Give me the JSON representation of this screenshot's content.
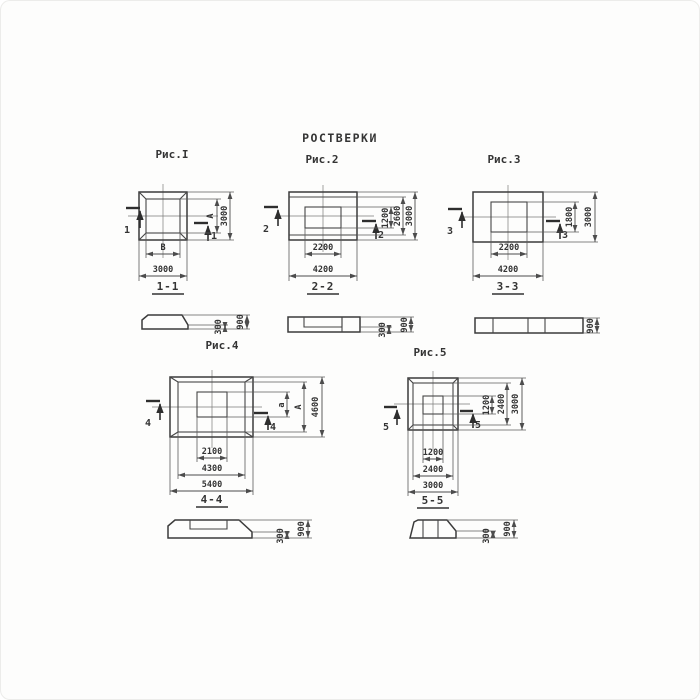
{
  "title": "РОСТВЕРКИ",
  "figures": {
    "fig1": {
      "caption": "Рис.I",
      "cut_number": "1",
      "section_title": "1-1",
      "inner_width": "В",
      "outer_width": "3000",
      "inner_height": "А",
      "outer_height": "3000",
      "section_bottom": "300",
      "section_total": "900"
    },
    "fig2": {
      "caption": "Рис.2",
      "cut_number": "2",
      "section_title": "2-2",
      "inner_width": "2200",
      "outer_width": "4200",
      "inner_height": "1200",
      "mid_height": "2600",
      "outer_height": "3000",
      "section_bottom": "300",
      "section_total": "900"
    },
    "fig3": {
      "caption": "Рис.3",
      "cut_number": "3",
      "section_title": "3-3",
      "inner_width": "2200",
      "outer_width": "4200",
      "inner_height": "1800",
      "outer_height": "3000",
      "section_total": "900"
    },
    "fig4": {
      "caption": "Рис.4",
      "cut_number": "4",
      "section_title": "4-4",
      "inner_width": "2100",
      "mid_width": "4300",
      "outer_width": "5400",
      "inner_height": "а",
      "mid_height": "А",
      "outer_height": "4600",
      "section_bottom": "300",
      "section_total": "900"
    },
    "fig5": {
      "caption": "Рис.5",
      "cut_number": "5",
      "section_title": "5-5",
      "inner_width": "1200",
      "mid_width": "2400",
      "outer_width": "3000",
      "inner_height": "1200",
      "mid_height": "2400",
      "outer_height": "3000",
      "section_bottom": "300",
      "section_total": "900"
    }
  }
}
